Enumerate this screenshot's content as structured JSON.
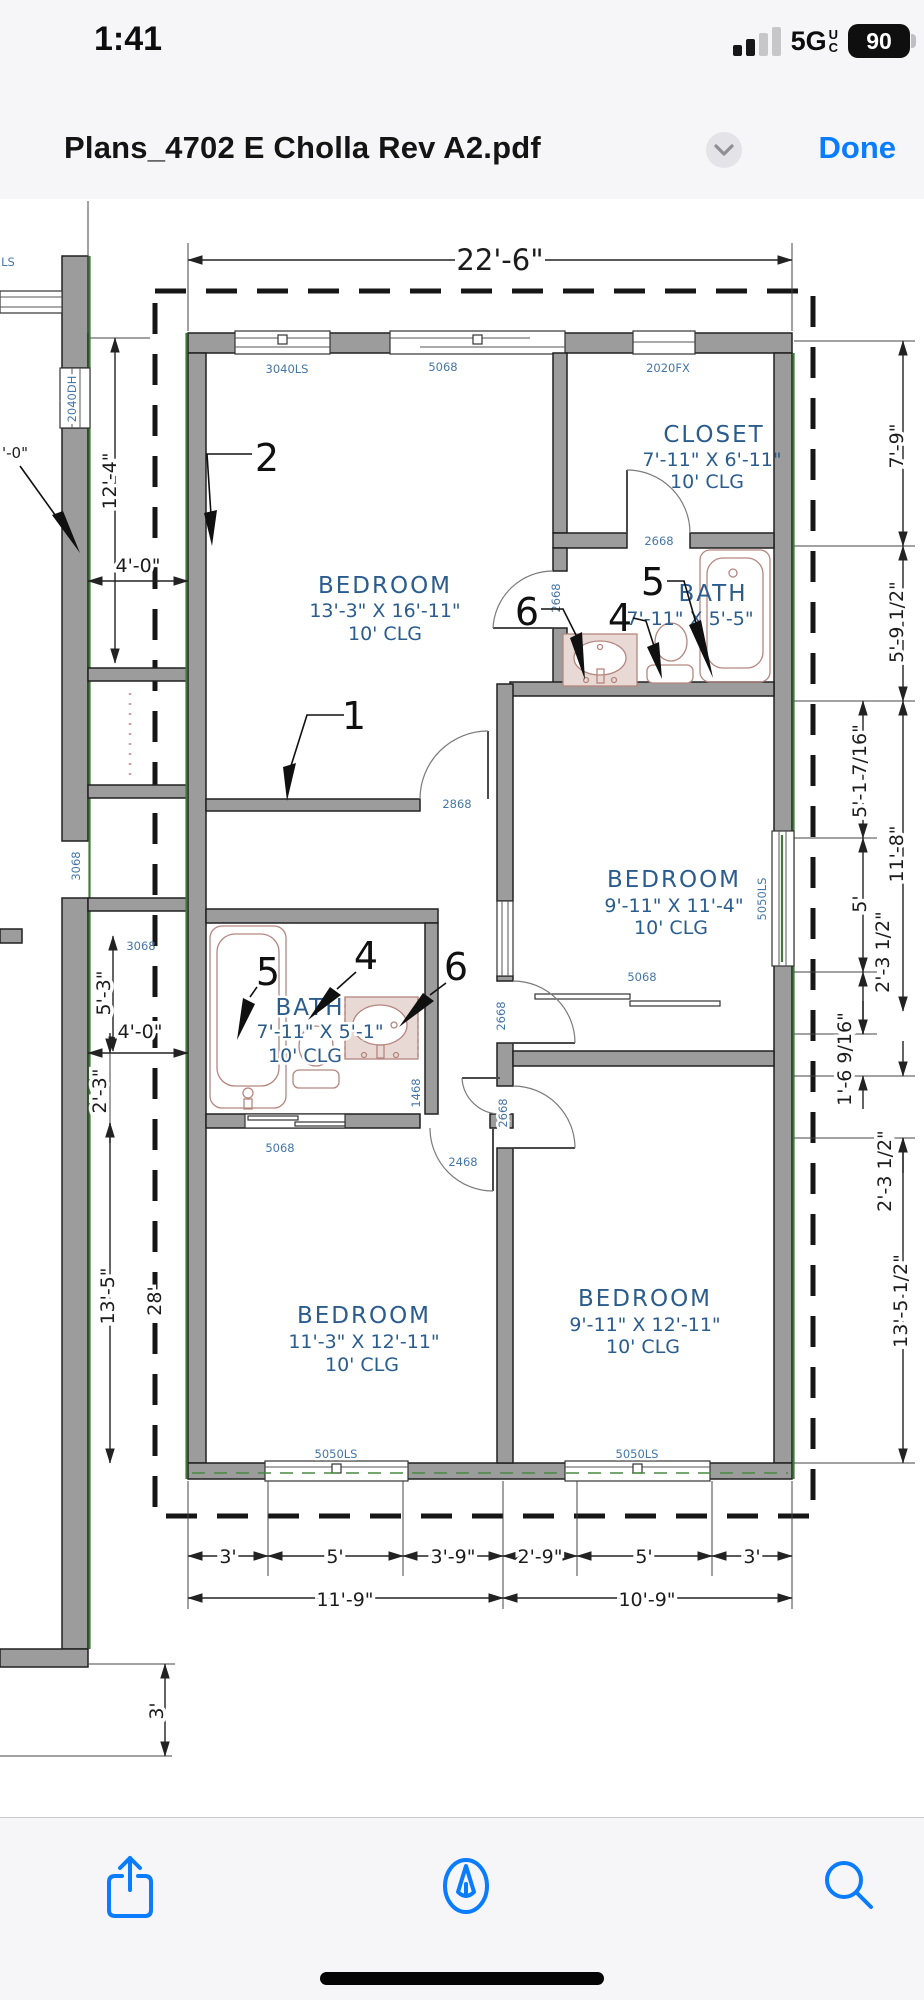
{
  "colors": {
    "accent": "#0a7cff",
    "plan_blue": "#2b5c8e",
    "opening_blue": "#4576a8",
    "wall_gray": "#9c9c9c",
    "overhang_green": "#3f7a37"
  },
  "status_bar": {
    "time": "1:41",
    "network": "5G",
    "network_qualifier_top": "U",
    "network_qualifier_bottom": "C",
    "battery_percent": "90"
  },
  "title_bar": {
    "title": "Plans_4702 E Cholla Rev A2.pdf",
    "done_label": "Done"
  },
  "plan": {
    "rooms": [
      {
        "name": "BEDROOM",
        "size": "13'-3\" X 16'-11\"",
        "ceiling": "10' CLG"
      },
      {
        "name": "CLOSET",
        "size": "7'-11\" X 6'-11\"",
        "ceiling": "10' CLG"
      },
      {
        "name": "BATH",
        "size": "7'-11\" X 5'-5\""
      },
      {
        "name": "BEDROOM",
        "size": "9'-11\" X 11'-4\"",
        "ceiling": "10' CLG"
      },
      {
        "name": "BATH",
        "size": "7'-11\" X 5'-1\"",
        "ceiling": "10' CLG"
      },
      {
        "name": "BEDROOM",
        "size": "11'-3\" X 12'-11\"",
        "ceiling": "10' CLG"
      },
      {
        "name": "BEDROOM",
        "size": "9'-11\" X 12'-11\"",
        "ceiling": "10' CLG"
      }
    ],
    "dims": {
      "overall_width": "22'-6\"",
      "left": [
        "12'-4\"",
        "4'-0\"",
        "5'-3\"",
        "4'-0\"",
        "2'-3\"",
        "13'-5\"",
        "28'",
        "3'"
      ],
      "left_partial": "'-0\"",
      "right": [
        "7'-9\"",
        "5'-9 1/2\"",
        "5'-1 7/16\"",
        "11'-8\"",
        "5'",
        "2'-3 1/2\"",
        "1'-6 9/16\"",
        "2'-3 1/2\"",
        "13'-5 1/2\""
      ],
      "bottom_segments": [
        "3'",
        "5'",
        "3'-9\"",
        "2'-9\"",
        "5'",
        "3'"
      ],
      "bottom_totals": [
        "11'-9\"",
        "10'-9\""
      ]
    },
    "openings": {
      "w3040ls": "3040LS",
      "w5068": "5068",
      "w2020fx": "2020FX",
      "w2040dh": "2040DH",
      "w5050ls": "5050LS",
      "w_partial": "LS",
      "d2668": "2668",
      "d2868": "2868",
      "d3068": "3068",
      "d1468": "1468",
      "d2468": "2468"
    },
    "callouts": [
      "1",
      "2",
      "4",
      "5",
      "6"
    ]
  }
}
